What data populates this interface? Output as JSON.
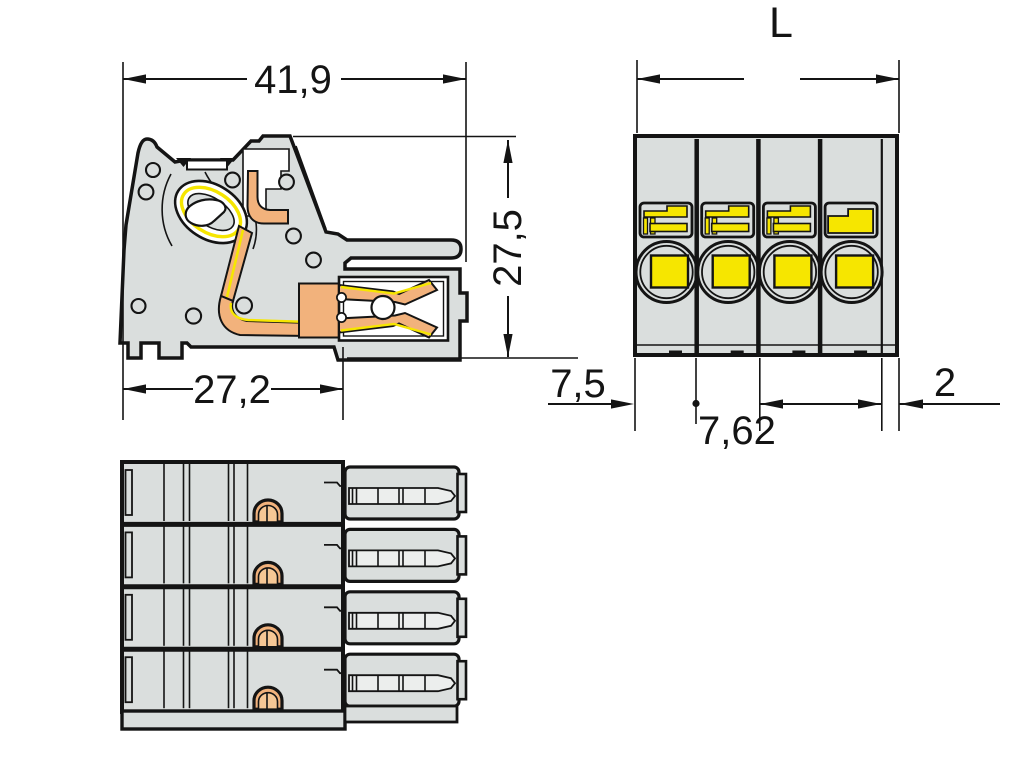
{
  "dimensions": {
    "side_view": {
      "overall_width": "41,9",
      "overall_height": "27,5",
      "housing_width": "27,2"
    },
    "front_view": {
      "total_length": "L",
      "edge_offset": "7,5",
      "pole_pitch": "7,62",
      "end_plate": "2"
    }
  },
  "front_view": {
    "pole_count": 4
  },
  "bottom_view": {
    "row_count": 4
  },
  "colors": {
    "housing_gray": "#dadedd",
    "inner_gray": "#eceeed",
    "outline_black": "#141414",
    "actuation_yellow": "#f6e600",
    "copper_orange": "#f2b27c",
    "copper_light": "#f6c795",
    "background_white": "#ffffff"
  }
}
